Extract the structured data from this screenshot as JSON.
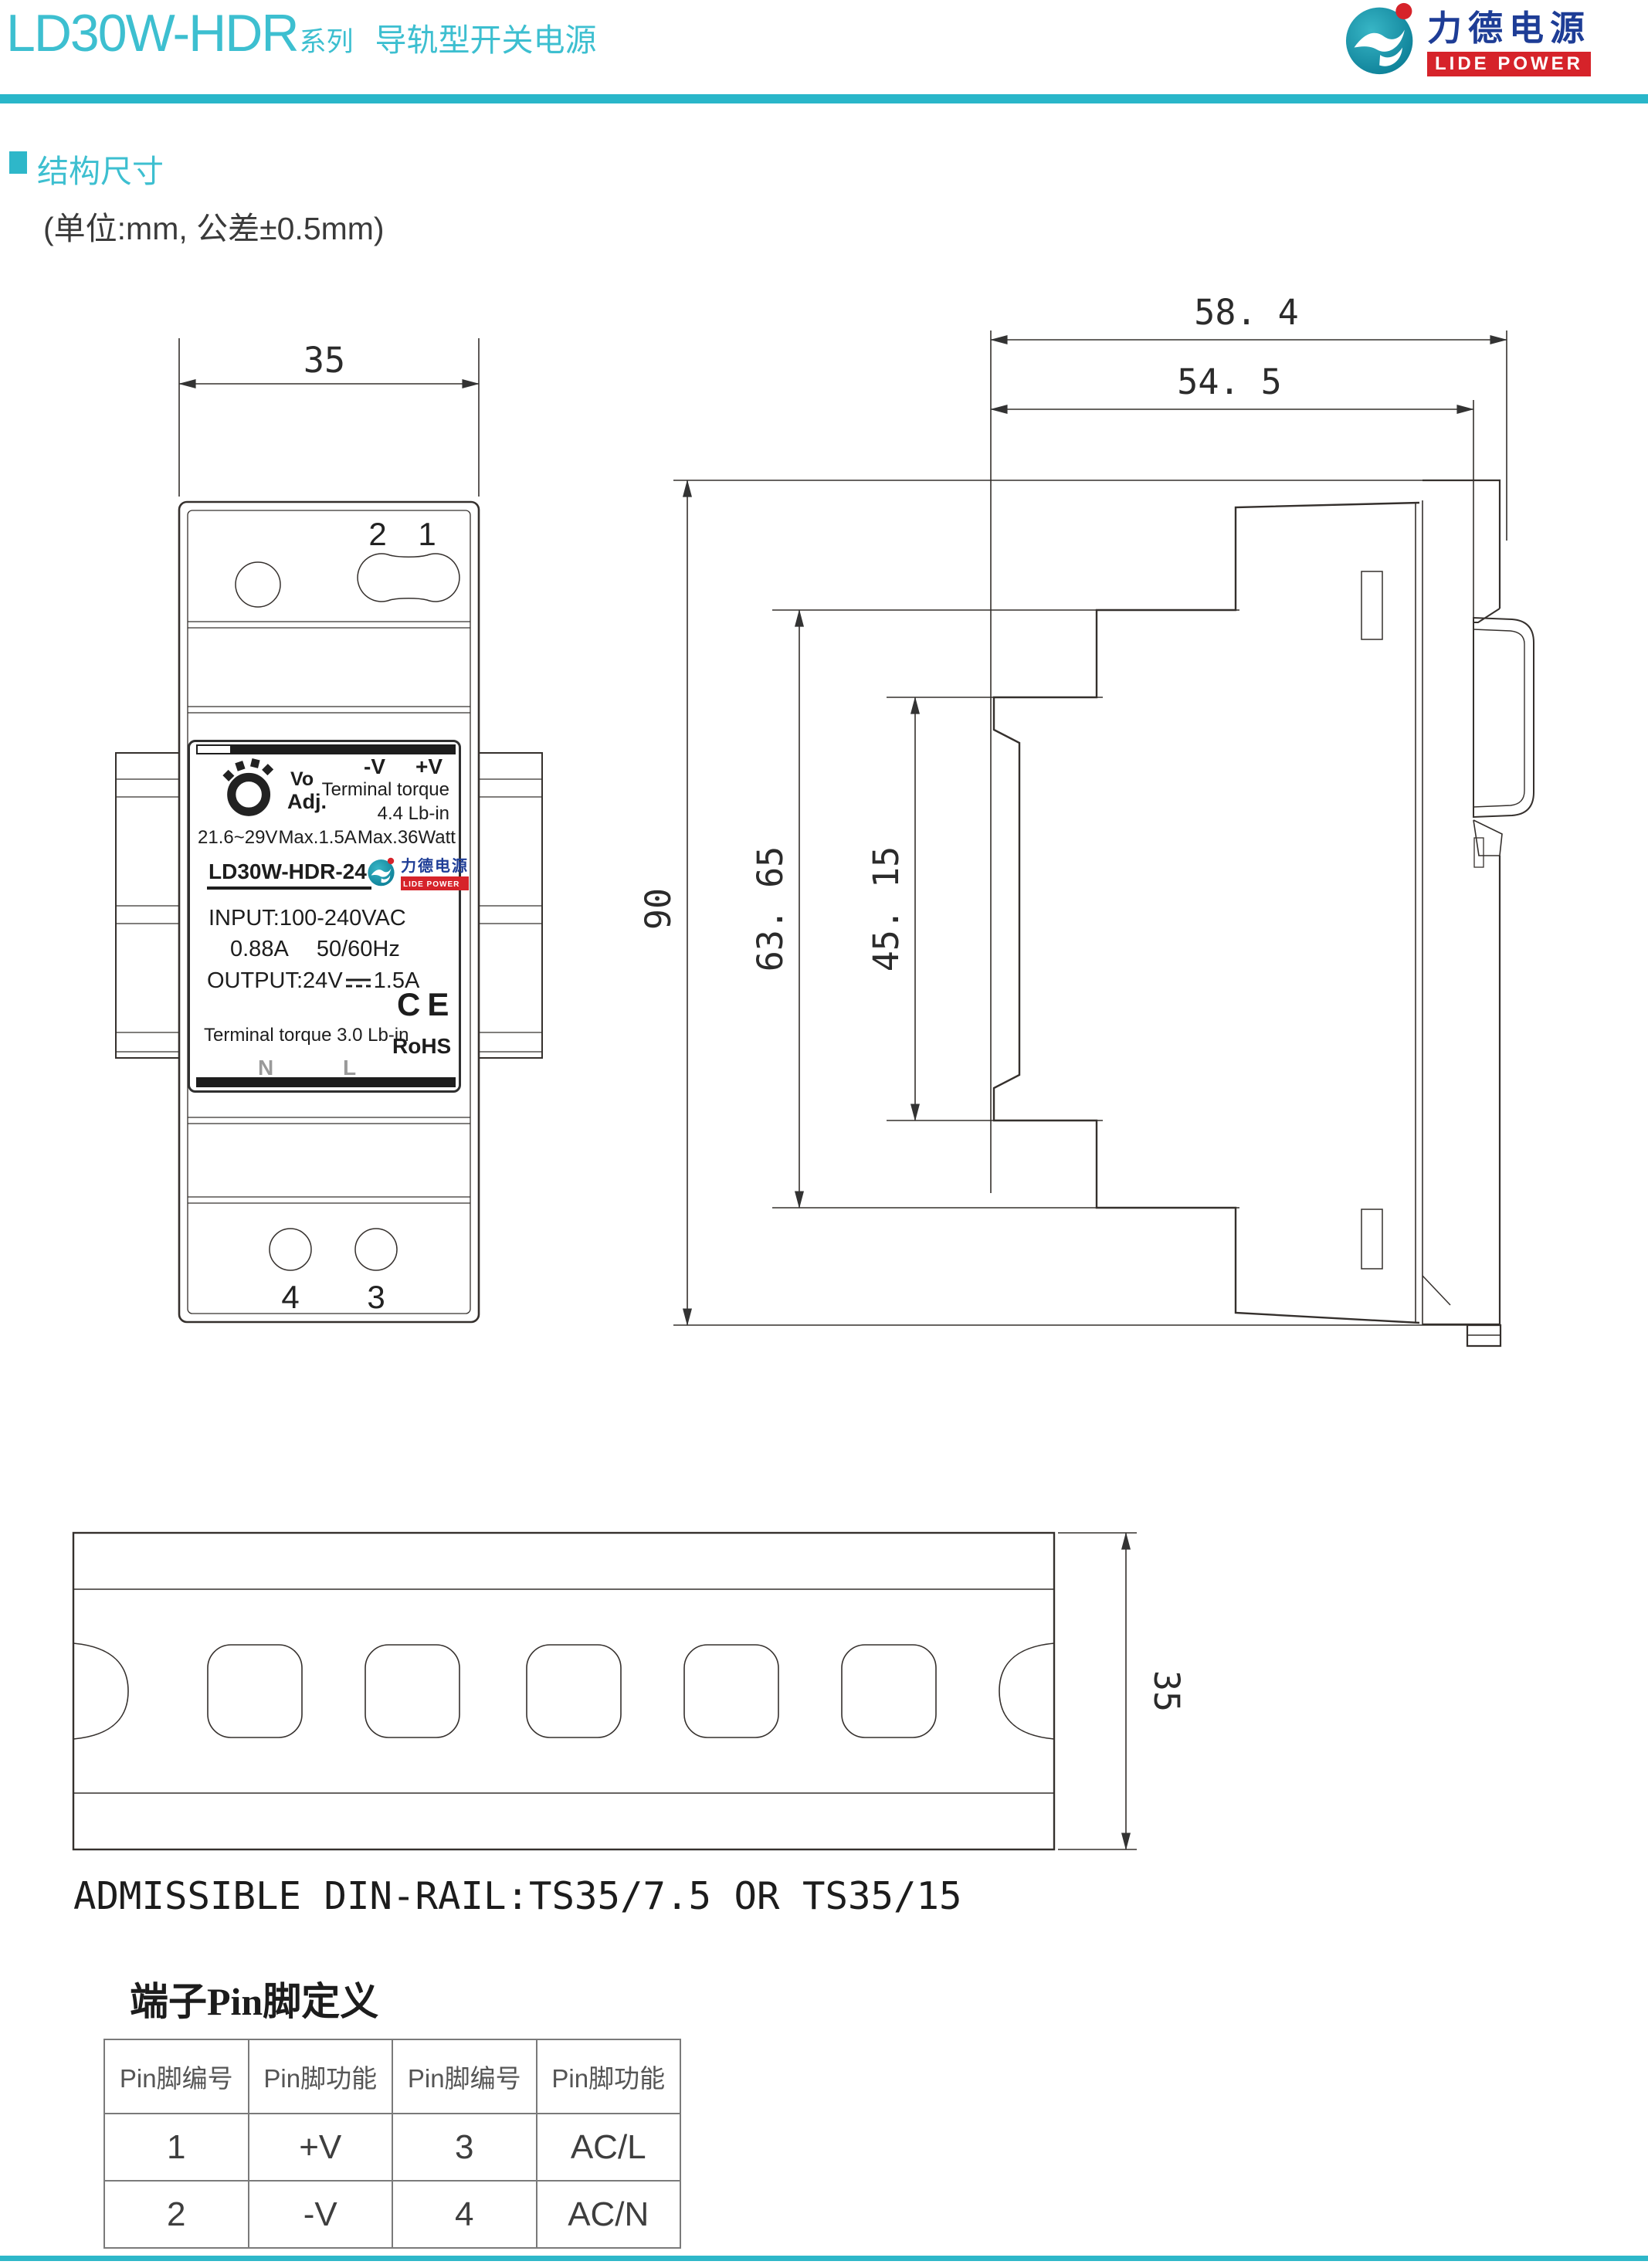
{
  "header": {
    "title_model": "LD30W-HDR",
    "title_series": "系列",
    "title_product": "导轨型开关电源",
    "logo_cn": "力德电源",
    "logo_en": "LIDE POWER",
    "accent_color": "#29b6c9",
    "title_color": "#3dbfd0",
    "logo_blue": "#1e3d96",
    "logo_red": "#d6232a"
  },
  "section": {
    "title": "结构尺寸",
    "unit_note": "(单位:mm, 公差±0.5mm)"
  },
  "front_view": {
    "dim_width": "35",
    "pins_top": [
      "2",
      "1"
    ],
    "pins_bottom": [
      "4",
      "3"
    ],
    "label": {
      "vo": "Vo",
      "adj": "Adj.",
      "neg": "-V",
      "pos": "+V",
      "torque1": "Terminal torque",
      "torque2": "4.4 Lb-in",
      "rating_v": "21.6~29V",
      "rating_a": "Max.1.5A",
      "rating_w": "Max.36Watt",
      "model": "LD30W-HDR-24",
      "logo_cn": "力德电源",
      "logo_en": "LIDE POWER",
      "input1": "INPUT:100-240VAC",
      "input2_a": "0.88A",
      "input2_b": "50/60Hz",
      "output_a": "OUTPUT:24V",
      "output_b": "1.5A",
      "ce": "CE",
      "torque3": "Terminal torque 3.0 Lb-in",
      "rohs": "RoHS",
      "n": "N",
      "l": "L"
    }
  },
  "side_view": {
    "dim_depth_total": "58. 4",
    "dim_depth_body": "54. 5",
    "dim_height": "90",
    "dim_h_outer": "63. 65",
    "dim_h_inner": "45. 15"
  },
  "rail_view": {
    "dim_height": "35",
    "caption": "ADMISSIBLE DIN-RAIL:TS35/7.5 OR TS35/15"
  },
  "pin_table": {
    "title": "端子Pin脚定义",
    "headers": [
      "Pin脚编号",
      "Pin脚功能",
      "Pin脚编号",
      "Pin脚功能"
    ],
    "rows": [
      [
        "1",
        "+V",
        "3",
        "AC/L"
      ],
      [
        "2",
        "-V",
        "4",
        "AC/N"
      ]
    ]
  }
}
